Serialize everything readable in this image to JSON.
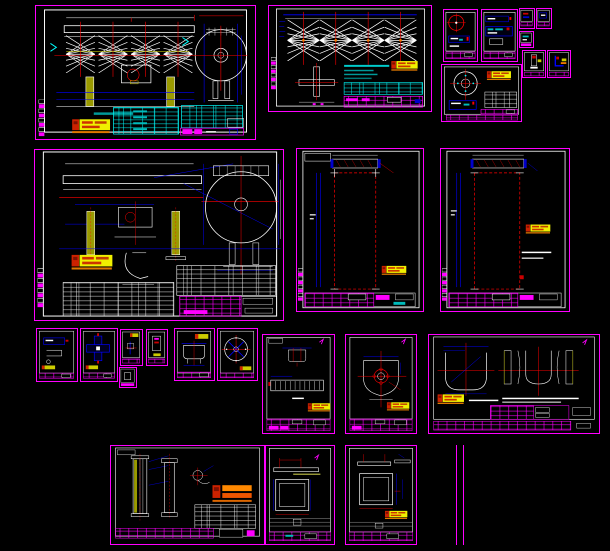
{
  "workspace": {
    "name": "CAD drawing set - model space overview",
    "background": "#000000"
  },
  "palette": {
    "sheet_frame": "#ff00ff",
    "sheet_inner_border": "#ffffff",
    "geometry_white": "#ffffff",
    "dimension_blue": "#0000ff",
    "centerline_red": "#ff0000",
    "table_cyan": "#00ffff",
    "stamp_yellow": "#f0f000",
    "stamp_orange": "#e07800",
    "stamp_red": "#cc2200",
    "leg_yellow": "#9a9a00"
  },
  "sheets": [
    {
      "id": "general-assembly",
      "label": "General assembly drawing"
    },
    {
      "id": "blade-trusses",
      "label": "Agitator blade truss drawing"
    },
    {
      "id": "detail-a",
      "label": "Detail sheet A"
    },
    {
      "id": "detail-b",
      "label": "Detail sheet B"
    },
    {
      "id": "drive-assembly",
      "label": "Drive assembly detail"
    },
    {
      "id": "part-t1",
      "label": "Small part sheet 1"
    },
    {
      "id": "part-t2",
      "label": "Small part sheet 2"
    },
    {
      "id": "part-t3",
      "label": "Small part sheet 3"
    },
    {
      "id": "part-t4",
      "label": "Small part sheet 4"
    },
    {
      "id": "part-t5",
      "label": "Small part sheet 5"
    },
    {
      "id": "weld-assembly",
      "label": "Welded assembly drawing"
    },
    {
      "id": "shell-plate-a",
      "label": "Shell plate drawing A"
    },
    {
      "id": "shell-plate-b",
      "label": "Shell plate drawing B"
    },
    {
      "id": "small-part-a",
      "label": "Part sheet A"
    },
    {
      "id": "small-part-b",
      "label": "Part sheet B"
    },
    {
      "id": "small-part-c",
      "label": "Part sheet C"
    },
    {
      "id": "small-part-d",
      "label": "Part sheet D"
    },
    {
      "id": "small-part-e",
      "label": "Part sheet E"
    },
    {
      "id": "trough-part",
      "label": "Trough part drawing"
    },
    {
      "id": "hand-wheel",
      "label": "Wheel / flange drawing"
    },
    {
      "id": "liner-comb",
      "label": "Liner comb profile drawing"
    },
    {
      "id": "end-shield",
      "label": "End shield drawing"
    },
    {
      "id": "trough-sections",
      "label": "Trough sections drawing"
    },
    {
      "id": "column-parts",
      "label": "Column parts drawing"
    },
    {
      "id": "frame-plate-a",
      "label": "Frame plate drawing A"
    },
    {
      "id": "frame-plate-b",
      "label": "Frame plate drawing B"
    },
    {
      "id": "partial-sheet",
      "label": "Partial sheet edge"
    }
  ]
}
